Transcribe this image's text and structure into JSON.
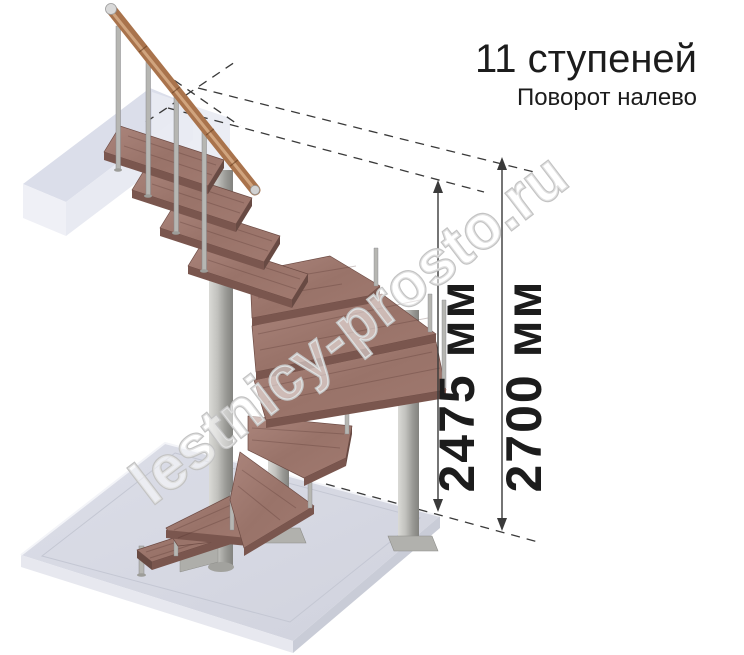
{
  "header": {
    "title": "11 ступеней",
    "subtitle": "Поворот налево"
  },
  "dimensions": [
    {
      "id": "stair-height",
      "label": "2475 мм"
    },
    {
      "id": "floor-height",
      "label": "2700 мм"
    }
  ],
  "watermark": {
    "text": "lestnicy-prosto.ru"
  },
  "colors": {
    "wood_top": "#9d7870",
    "wood_edge": "#7a564e",
    "metal": "#b6b6b2",
    "floor_slab": "#d7d9e3",
    "handrail": "#a9734c",
    "annotation": "#3a3a3a",
    "text": "#1c1c1c",
    "watermark_outline": "#c3c3c3"
  }
}
